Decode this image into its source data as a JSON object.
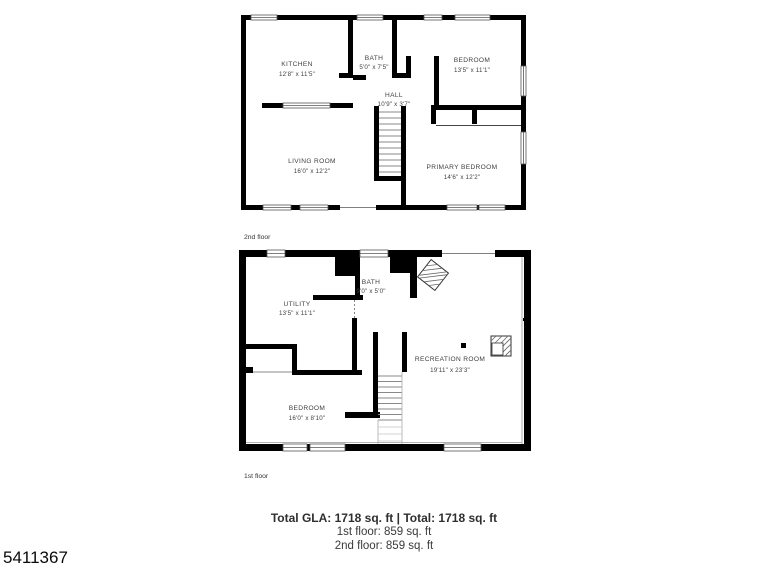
{
  "meta": {
    "photo_id": "5411367"
  },
  "floors": {
    "second": {
      "label": "2nd floor",
      "rooms": {
        "kitchen": {
          "name": "KITCHEN",
          "dims": "12'8\" x 11'5\""
        },
        "bath": {
          "name": "BATH",
          "dims": "5'0\" x 7'5\""
        },
        "bedroom": {
          "name": "BEDROOM",
          "dims": "13'5\" x 11'1\""
        },
        "hall": {
          "name": "HALL",
          "dims": "10'9\" x 3'7\""
        },
        "living": {
          "name": "LIVING ROOM",
          "dims": "16'0\" x 12'2\""
        },
        "primary": {
          "name": "PRIMARY BEDROOM",
          "dims": "14'6\" x 12'2\""
        }
      }
    },
    "first": {
      "label": "1st floor",
      "rooms": {
        "bath": {
          "name": "BATH",
          "dims": "9'0\" x 5'0\""
        },
        "utility": {
          "name": "UTILITY",
          "dims": "13'5\" x 11'1\""
        },
        "recreation": {
          "name": "RECREATION ROOM",
          "dims": "19'11\" x 23'3\""
        },
        "bedroom": {
          "name": "BEDROOM",
          "dims": "16'0\" x 8'10\""
        }
      }
    }
  },
  "summary": {
    "total": "Total GLA: 1718 sq. ft | Total: 1718 sq. ft",
    "first": "1st floor: 859 sq. ft",
    "second": "2nd floor: 859 sq. ft"
  },
  "colors": {
    "wall": "#000000",
    "label_text": "#3f3f3f",
    "summary_text": "#333333"
  }
}
